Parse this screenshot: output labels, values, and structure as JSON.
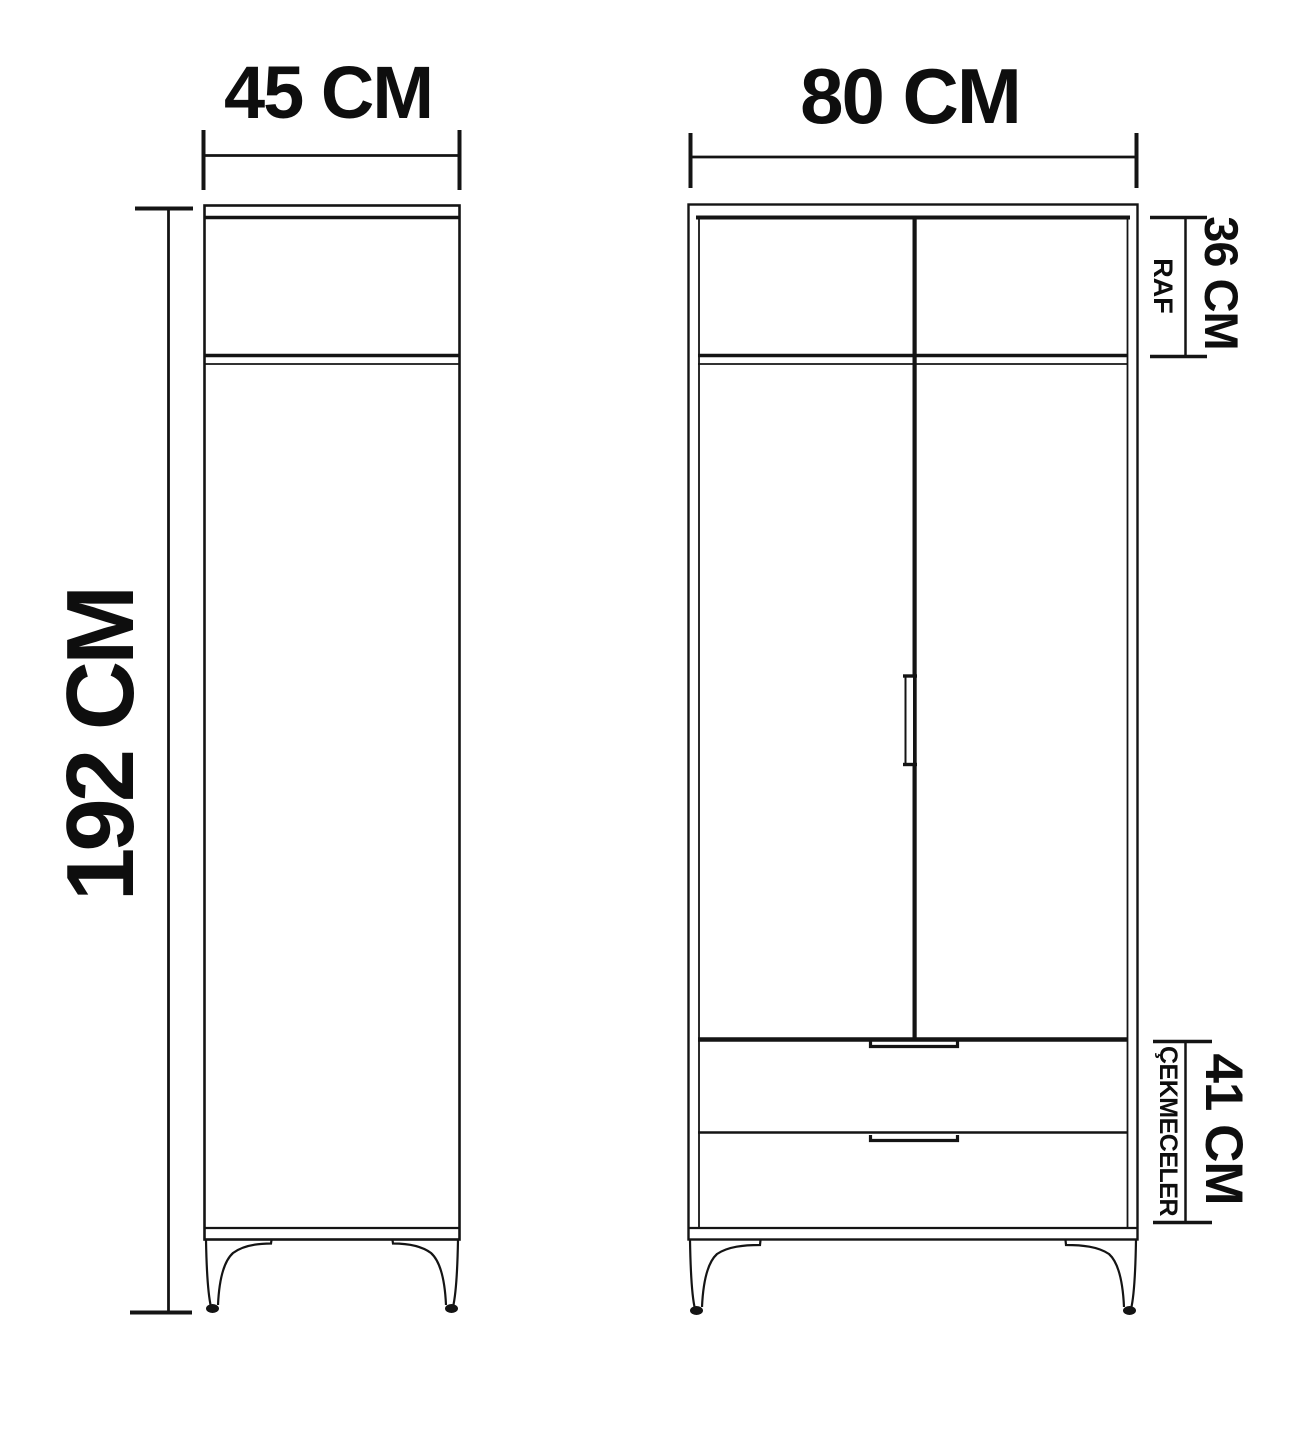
{
  "diagram": {
    "description": "Wardrobe technical dimension drawing, side view and front view",
    "side_view": {
      "width_label": "45 CM",
      "height_label": "192 CM"
    },
    "front_view": {
      "width_label": "80 CM",
      "shelf_section": {
        "name_label": "RAF",
        "height_label": "36 CM"
      },
      "drawer_section": {
        "name_label": "ÇEKMECELER",
        "height_label": "41 CM"
      }
    }
  },
  "colors": {
    "ink": "#141414",
    "background": "#ffffff"
  }
}
